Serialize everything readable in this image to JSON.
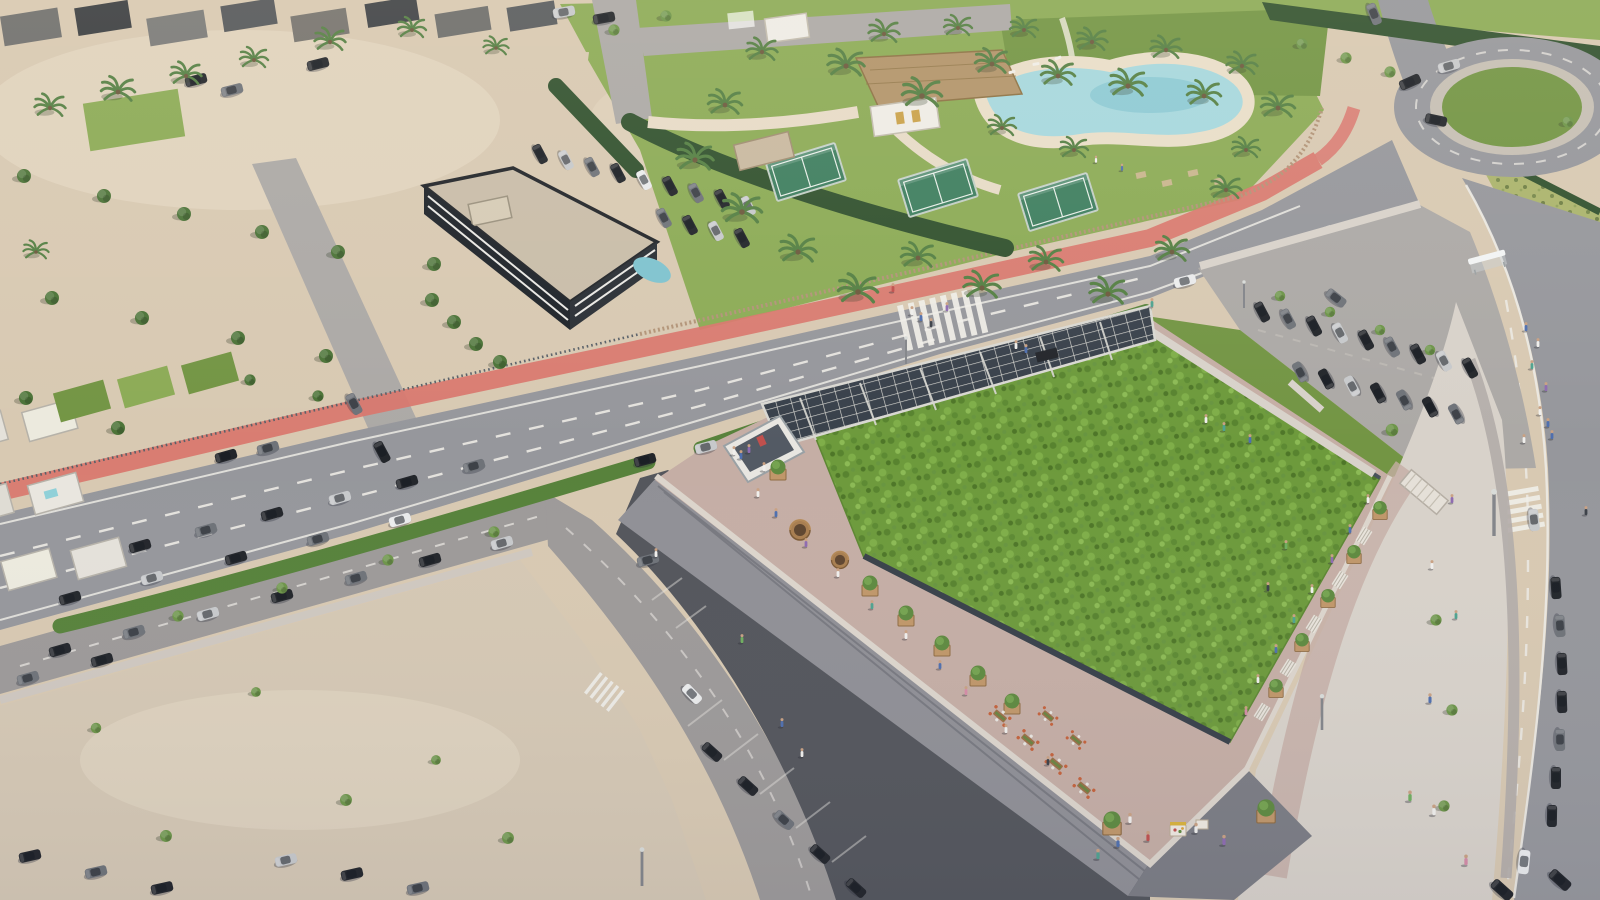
{
  "scene": {
    "description": "Aerial daylight rendering of a flat-roofed commercial building topped by a large planted green roof with a rooftop promenade, round timber kiosks, tree planters, communal dining tables and a solar-panel canopy; surrounded by a multi-lane road with a red bike lane and zebra crossings, surface parking lots with rows of cars, a sandy vacant lot, white villas with pools, a dark three-storey apartment block, a sports club with padel courts, a thatched clubhouse and a lagoon pool with palm trees, a roundabout, hedges, and pedestrians on wide curving sidewalks.",
    "time_of_day": "day",
    "view": "aerial-oblique",
    "inventory": {
      "padel_courts": 3,
      "rooftop_kiosks": 2,
      "roundabout": 1,
      "zebra_crossings": 3,
      "solar_canopy": 1,
      "bus_shelter": 1,
      "lagoon_pool": 1,
      "thatched_clubhouse": 1,
      "market_stall": 1
    }
  },
  "colors": {
    "sand": "#d8c9b2",
    "sandLight": "#e7dbc7",
    "sandLot": "#d5c8b4",
    "roadMain": "#96979c",
    "roadLight": "#aca9a6",
    "roadService": "#9d9a99",
    "laneMark": "#eceae4",
    "bikeLane": "#d9766d",
    "hedgeBright": "#57823b",
    "hedgeDark": "#32522f",
    "grass": "#8cab56",
    "grassDark": "#739544",
    "garrigue": "#abb46d",
    "pool": "#a6d8de",
    "poolDeep": "#7fc3cf",
    "greenRoofBase": "#6d9a3c",
    "pavePink": "#c5aea5",
    "paveLight": "#d8d2ca",
    "paveGray": "#b3aca8",
    "wallGray": "#909096",
    "wallDark": "#7c7d84",
    "parapet": "#dcd5cc",
    "parkingDark": "#54565c",
    "bldDark": "#2b3036",
    "bldBand": "#e9e8e4",
    "roofBeige": "#c9bda9",
    "thatch": "#b2946a",
    "whiteBld": "#efece6",
    "courtGreen": "#3f7f60",
    "solar": "#39414b",
    "solarFrame": "#d9d8d2",
    "wood": "#b08a5e",
    "woodFence": "#b29478",
    "carDark": "#23262b",
    "carGray": "#6f7379",
    "carSilver": "#c7c9cb",
    "carWhite": "#e9eaeb",
    "treeGreen": "#4c7338",
    "treeLight": "#6d9549",
    "palmGreen": "#558044"
  }
}
